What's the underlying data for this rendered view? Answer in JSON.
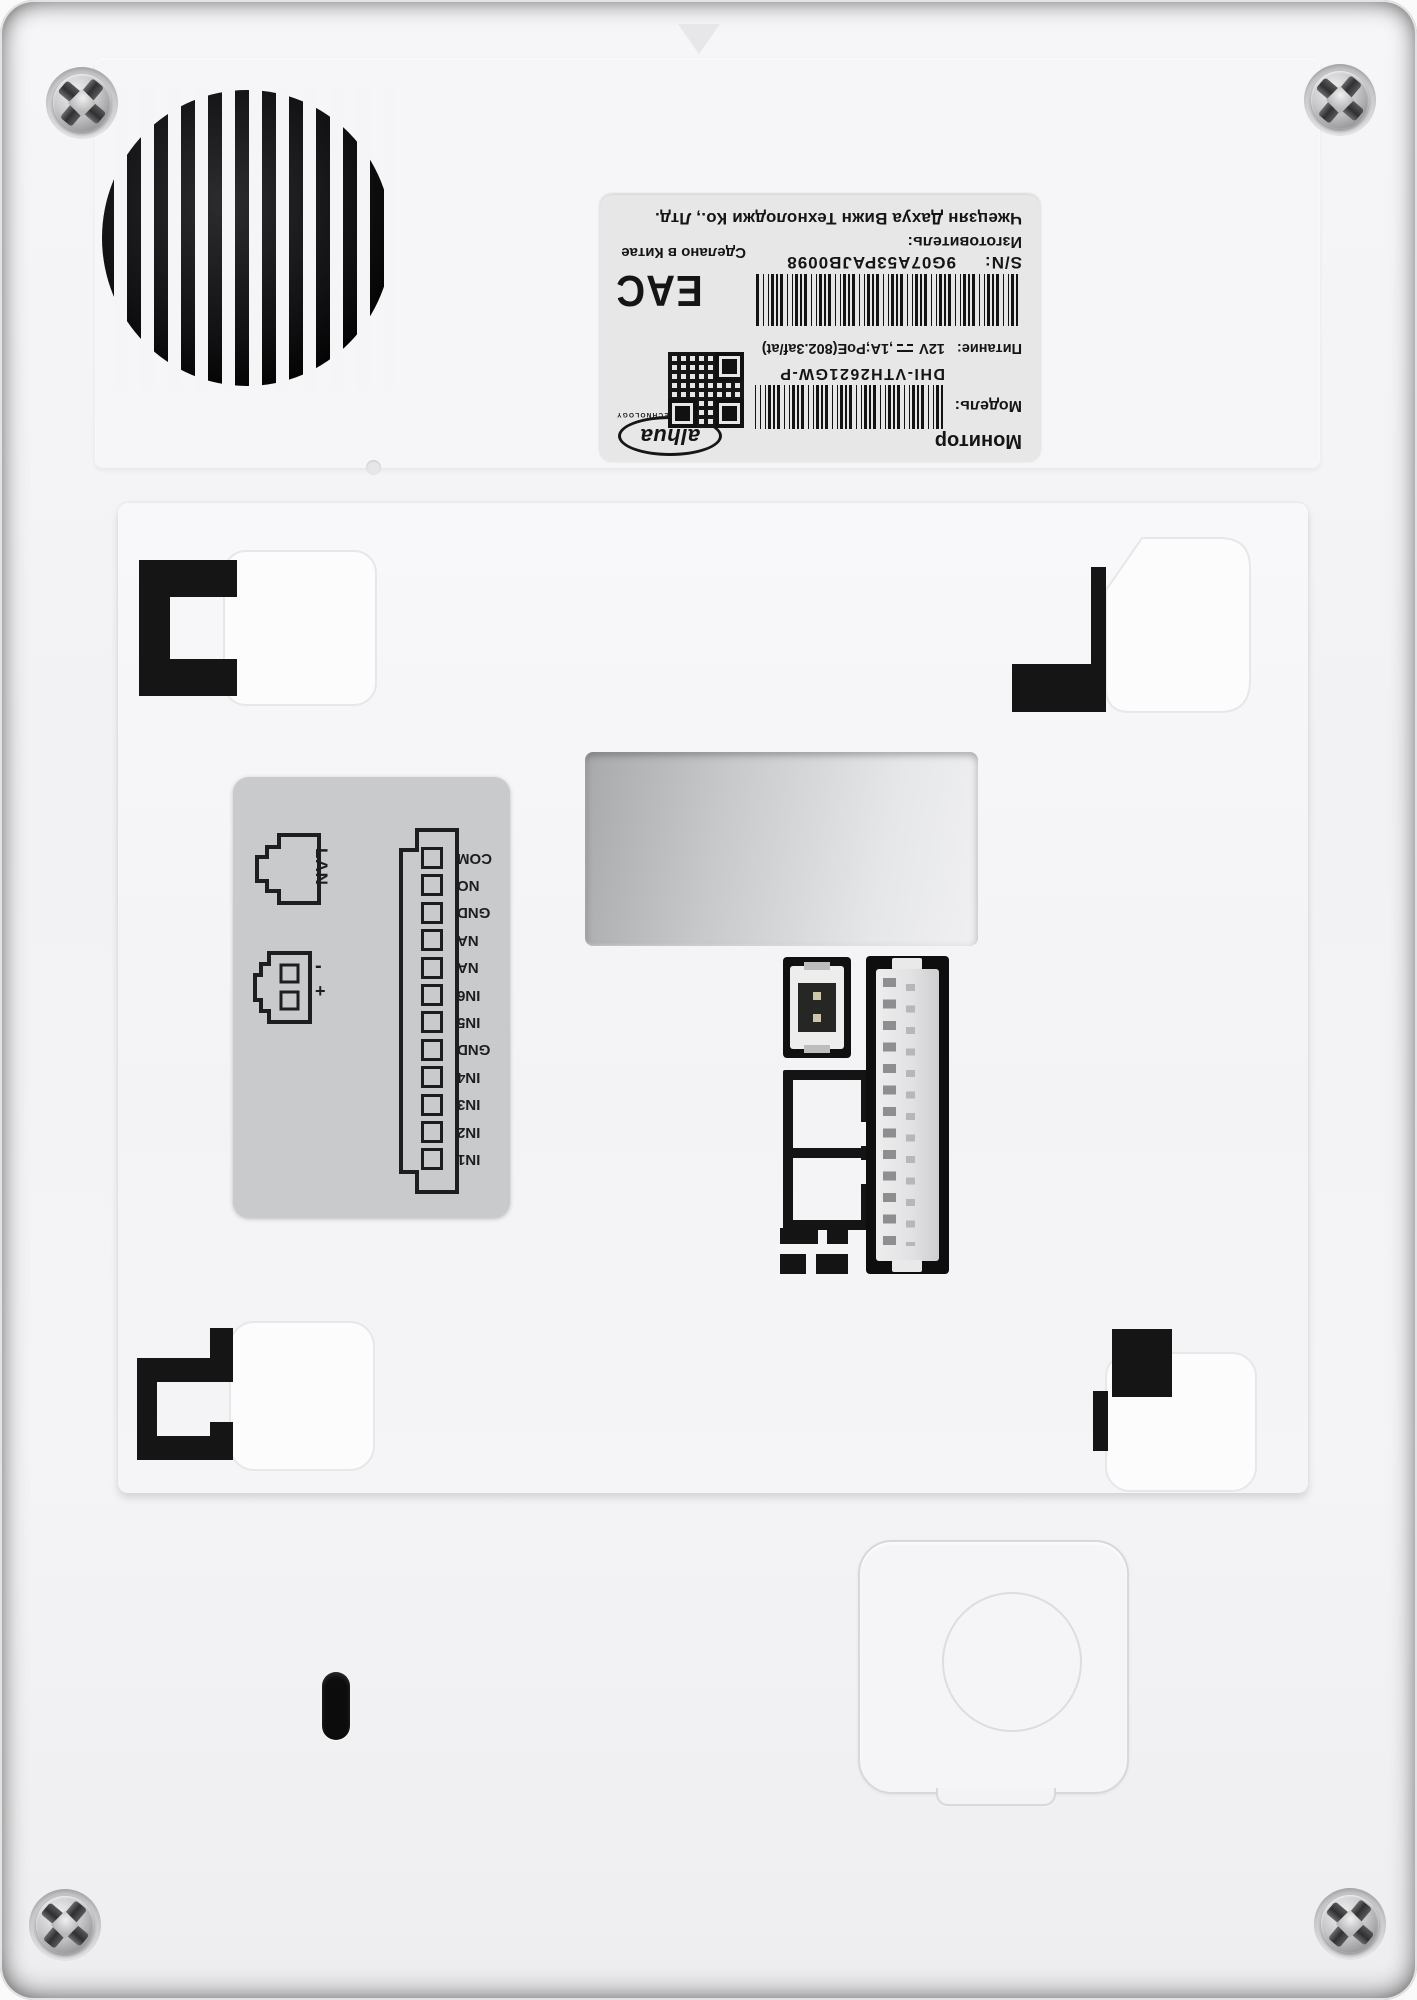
{
  "product_label": {
    "device_type": "Монитор",
    "model_label": "Модель:",
    "model_value": "DHI-VTH2621GW-P",
    "power_label": "Питание:",
    "power_voltage": "12V",
    "power_rest": ",1A;PoE(802.3af/at)",
    "sn_label": "S/N:",
    "sn_value": "9G07A53PAJB0098",
    "manufacturer_label": "Изготовитель:",
    "manufacturer_value": "Чжецзян Дахуа Вижн Технолоджи Ко., Лтд.",
    "made_in": "Сделано в Китае",
    "eac_mark": "EAC",
    "brand_logo_text": "alhua",
    "brand_logo_subtext": "TECHNOLOGY"
  },
  "port_sticker": {
    "lan_label": "LAN",
    "minus_label": "-",
    "plus_label": "+",
    "terminal_labels": [
      "COM",
      "NO",
      "GND",
      "NA",
      "NA",
      "IN6",
      "IN5",
      "GND",
      "IN4",
      "IN3",
      "IN2",
      "IN1"
    ]
  },
  "colors": {
    "body": "#f3f3f5",
    "label_bg": "#e7e7e7",
    "sticker_bg": "#c9cacb",
    "ink": "#1b1b1b",
    "cutout_black": "#101010"
  }
}
